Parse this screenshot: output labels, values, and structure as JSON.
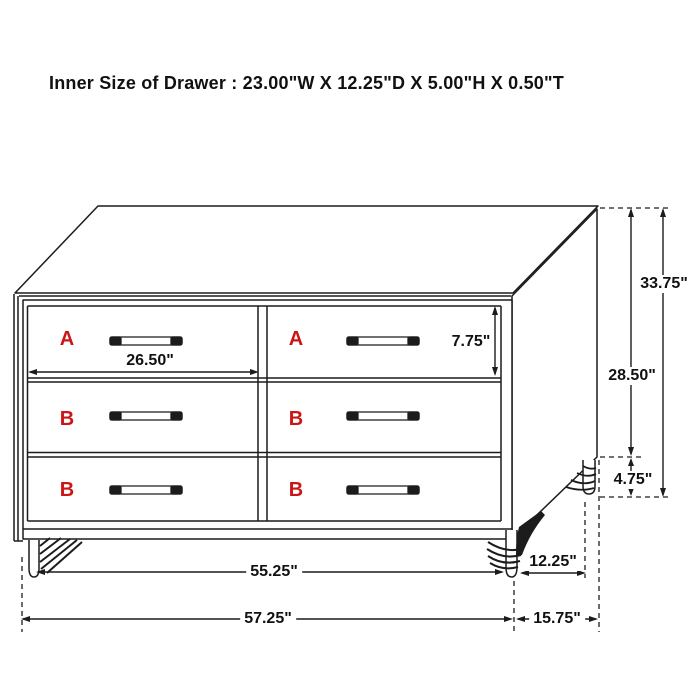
{
  "title": "Inner Size of Drawer : 23.00\"W X 12.25\"D X 5.00\"H X 0.50\"T",
  "colors": {
    "line": "#1c1c1c",
    "drawer_label": "#cc1616",
    "text": "#111111",
    "background": "#ffffff"
  },
  "drawer_labels": [
    "A",
    "A",
    "B",
    "B",
    "B",
    "B"
  ],
  "dimensions": {
    "drawer_width": "26.50\"",
    "drawer_front_height": "7.75\"",
    "overall_height": "33.75\"",
    "case_height": "28.50\"",
    "leg_height": "4.75\"",
    "width_between_legs": "55.25\"",
    "depth_between_legs": "12.25\"",
    "overall_width": "57.25\"",
    "overall_depth": "15.75\""
  }
}
